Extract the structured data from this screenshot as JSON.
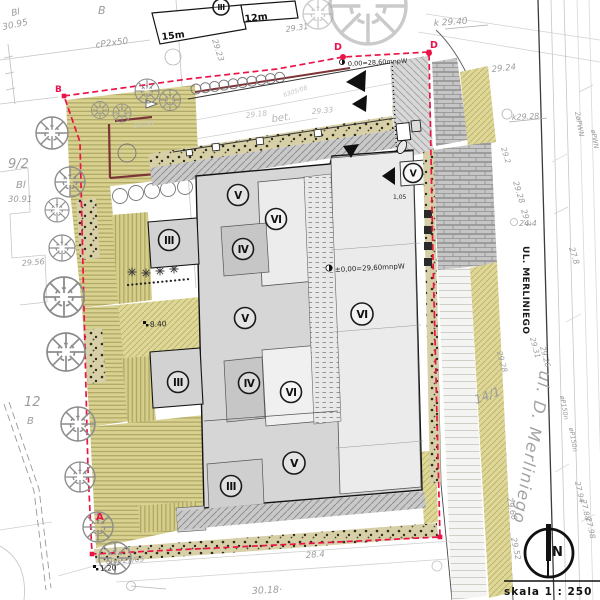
{
  "drawing": {
    "scale_label": "skala 1 : 250",
    "north_label": "N",
    "streets": {
      "main": "UL. MERLINIEGO",
      "secondary": "ul. D. Merliniego"
    },
    "site_levels": {
      "building_zero": "±0,00=29,60mnpW",
      "entrance_zero": "0,00=28,60mnpW"
    },
    "icons": {
      "north-arrow-icon": "circle-with-needle",
      "tree-icon": "circle-with-radial-branches",
      "shrub-icon": "starburst",
      "manhole-icon": "small-circle",
      "section-arrow-icon": "filled-triangle"
    },
    "accent_colors": {
      "boundary_red": "#ec1347",
      "wall_maroon": "#7d3436",
      "lawn_olive": "#d8d190"
    },
    "building_units": [
      {
        "label": "III",
        "x": 221,
        "y": 7,
        "r": 8
      },
      {
        "label": "V",
        "x": 238,
        "y": 195,
        "r": 10.5
      },
      {
        "label": "VI",
        "x": 276,
        "y": 219,
        "r": 10.5
      },
      {
        "label": "IV",
        "x": 243,
        "y": 249,
        "r": 10.5
      },
      {
        "label": "III",
        "x": 169,
        "y": 240,
        "r": 10.5
      },
      {
        "label": "V",
        "x": 245,
        "y": 318,
        "r": 10.5
      },
      {
        "label": "VI",
        "x": 362,
        "y": 314,
        "r": 11
      },
      {
        "label": "V",
        "x": 413,
        "y": 173,
        "r": 9.5
      },
      {
        "label": "III",
        "x": 178,
        "y": 382,
        "r": 10.5
      },
      {
        "label": "IV",
        "x": 249,
        "y": 383,
        "r": 10.5
      },
      {
        "label": "VI",
        "x": 291,
        "y": 392,
        "r": 10.5
      },
      {
        "label": "V",
        "x": 294,
        "y": 463,
        "r": 11
      },
      {
        "label": "III",
        "x": 231,
        "y": 486,
        "r": 10.5
      }
    ],
    "labels": [
      {
        "t": "Bl",
        "x": 12,
        "y": 16,
        "r": -12,
        "s": 9
      },
      {
        "t": "30.95",
        "x": 3,
        "y": 30,
        "r": -12,
        "s": 9
      },
      {
        "t": "B",
        "x": 98,
        "y": 14,
        "s": 11
      },
      {
        "t": "cP2x50",
        "x": 96,
        "y": 48,
        "r": -8,
        "s": 9
      },
      {
        "t": "29.23",
        "x": 212,
        "y": 40,
        "r": 72
      },
      {
        "t": "29.31",
        "x": 286,
        "y": 32,
        "r": -8
      },
      {
        "t": "9/2",
        "x": 8,
        "y": 168,
        "s": 13
      },
      {
        "t": "Bl",
        "x": 16,
        "y": 188,
        "s": 10
      },
      {
        "t": "30.91",
        "x": 8,
        "y": 202,
        "s": 8.5
      },
      {
        "t": "29.56",
        "x": 22,
        "y": 266,
        "r": -5
      },
      {
        "t": "12",
        "x": 24,
        "y": 406,
        "s": 13
      },
      {
        "t": "B",
        "x": 27,
        "y": 424,
        "s": 10
      },
      {
        "t": "k 29.40",
        "x": 434,
        "y": 26,
        "r": -4,
        "s": 9
      },
      {
        "t": "29.24",
        "x": 492,
        "y": 72,
        "r": -6,
        "s": 8.5
      },
      {
        "t": "k29.28",
        "x": 512,
        "y": 120,
        "r": -3
      },
      {
        "t": "29.28",
        "x": 513,
        "y": 182,
        "r": 73
      },
      {
        "t": "29.3",
        "x": 521,
        "y": 210,
        "r": 73
      },
      {
        "t": "24.4",
        "x": 519,
        "y": 226
      },
      {
        "t": "27.8",
        "x": 569,
        "y": 248,
        "r": 73
      },
      {
        "t": "2øPWN",
        "x": 575,
        "y": 112,
        "r": 80,
        "s": 7
      },
      {
        "t": "øPWN",
        "x": 591,
        "y": 130,
        "r": 80,
        "s": 6.5
      },
      {
        "t": "29.2",
        "x": 501,
        "y": 148,
        "r": 73,
        "s": 7.5
      },
      {
        "t": "29.31",
        "x": 530,
        "y": 338,
        "r": 75,
        "s": 7.5
      },
      {
        "t": "29.26",
        "x": 540,
        "y": 347,
        "r": 75,
        "s": 7.5
      },
      {
        "t": "29.28",
        "x": 497,
        "y": 352,
        "r": 75,
        "s": 7.5
      },
      {
        "t": "14/1",
        "x": 476,
        "y": 404,
        "r": -20,
        "s": 12
      },
      {
        "t": "29.66",
        "x": 507,
        "y": 498,
        "r": 78
      },
      {
        "t": "29.52",
        "x": 511,
        "y": 538,
        "r": 78
      },
      {
        "t": "27.94",
        "x": 575,
        "y": 482,
        "r": 78,
        "s": 7.5
      },
      {
        "t": "27.88",
        "x": 581,
        "y": 500,
        "r": 78,
        "s": 7.5
      },
      {
        "t": "27.98",
        "x": 586,
        "y": 518,
        "r": 78,
        "s": 7.5
      },
      {
        "t": "øP150n",
        "x": 560,
        "y": 396,
        "r": 80,
        "s": 6.5
      },
      {
        "t": "øP150n",
        "x": 569,
        "y": 428,
        "r": 80,
        "s": 6.5
      },
      {
        "t": "28.4",
        "x": 306,
        "y": 558,
        "r": -4,
        "s": 8.5
      },
      {
        "t": "30.18·",
        "x": 252,
        "y": 594,
        "r": -3,
        "s": 9.5
      },
      {
        "t": "606/21/05",
        "x": 106,
        "y": 564,
        "r": -4,
        "s": 7.5
      },
      {
        "t": "bet.",
        "x": 272,
        "y": 122,
        "r": -7,
        "s": 10,
        "c": "#b7b7b7"
      },
      {
        "t": "29.18",
        "x": 246,
        "y": 118,
        "r": -7,
        "s": 7.5,
        "c": "#bfbfbf"
      },
      {
        "t": "29.33",
        "x": 312,
        "y": 114,
        "r": -5,
        "s": 7.5,
        "c": "#b7b7b7"
      },
      {
        "t": "6305/08",
        "x": 284,
        "y": 97,
        "r": -18,
        "s": 6,
        "c": "#c6c6c6"
      },
      {
        "t": "10.00",
        "x": 134,
        "y": 128,
        "r": -8,
        "s": 7,
        "c": "#c8c8c8"
      },
      {
        "t": "±0,00=29,60mnpW",
        "x": 335,
        "y": 272,
        "r": -3,
        "s": 7,
        "c": "#1d1d1d",
        "i": 0,
        "n": "level-annotation"
      },
      {
        "t": "0,00=28,60mnpW",
        "x": 348,
        "y": 66,
        "r": -3,
        "s": 6.5,
        "c": "#1d1d1d",
        "i": 0,
        "n": "level-annotation"
      },
      {
        "t": "8.40",
        "x": 150,
        "y": 327,
        "r": -3,
        "s": 7.5,
        "c": "#1d1d1d",
        "i": 0,
        "n": "dimension-label"
      },
      {
        "t": "1,20",
        "x": 100,
        "y": 571,
        "r": -3,
        "s": 7.5,
        "c": "#1d1d1d",
        "i": 0,
        "n": "dimension-label"
      },
      {
        "t": "1,05",
        "x": 393,
        "y": 199,
        "s": 6,
        "c": "#1d1d1d",
        "i": 0,
        "n": "dimension-label"
      },
      {
        "t": "15m",
        "x": 162,
        "y": 40,
        "r": -7,
        "s": 9.5,
        "c": "#111111",
        "i": 0,
        "w": 700,
        "n": "existing-building-dim"
      },
      {
        "t": "12m",
        "x": 245,
        "y": 22,
        "r": -7,
        "s": 9.5,
        "c": "#111111",
        "i": 0,
        "w": 700,
        "n": "existing-building-dim"
      },
      {
        "t": "B",
        "x": 55,
        "y": 92,
        "s": 9,
        "c": "#e8134a",
        "i": 0,
        "w": 700,
        "n": "boundary-point-label"
      },
      {
        "t": "A",
        "x": 96,
        "y": 520,
        "s": 10,
        "c": "#e8134a",
        "i": 0,
        "w": 700,
        "n": "boundary-point-label"
      },
      {
        "t": "D",
        "x": 334,
        "y": 50,
        "s": 9.5,
        "c": "#e8134a",
        "i": 0,
        "w": 700,
        "n": "boundary-point-label"
      },
      {
        "t": "D",
        "x": 430,
        "y": 48,
        "s": 9.5,
        "c": "#e8134a",
        "i": 0,
        "w": 700,
        "n": "boundary-point-label"
      }
    ]
  }
}
